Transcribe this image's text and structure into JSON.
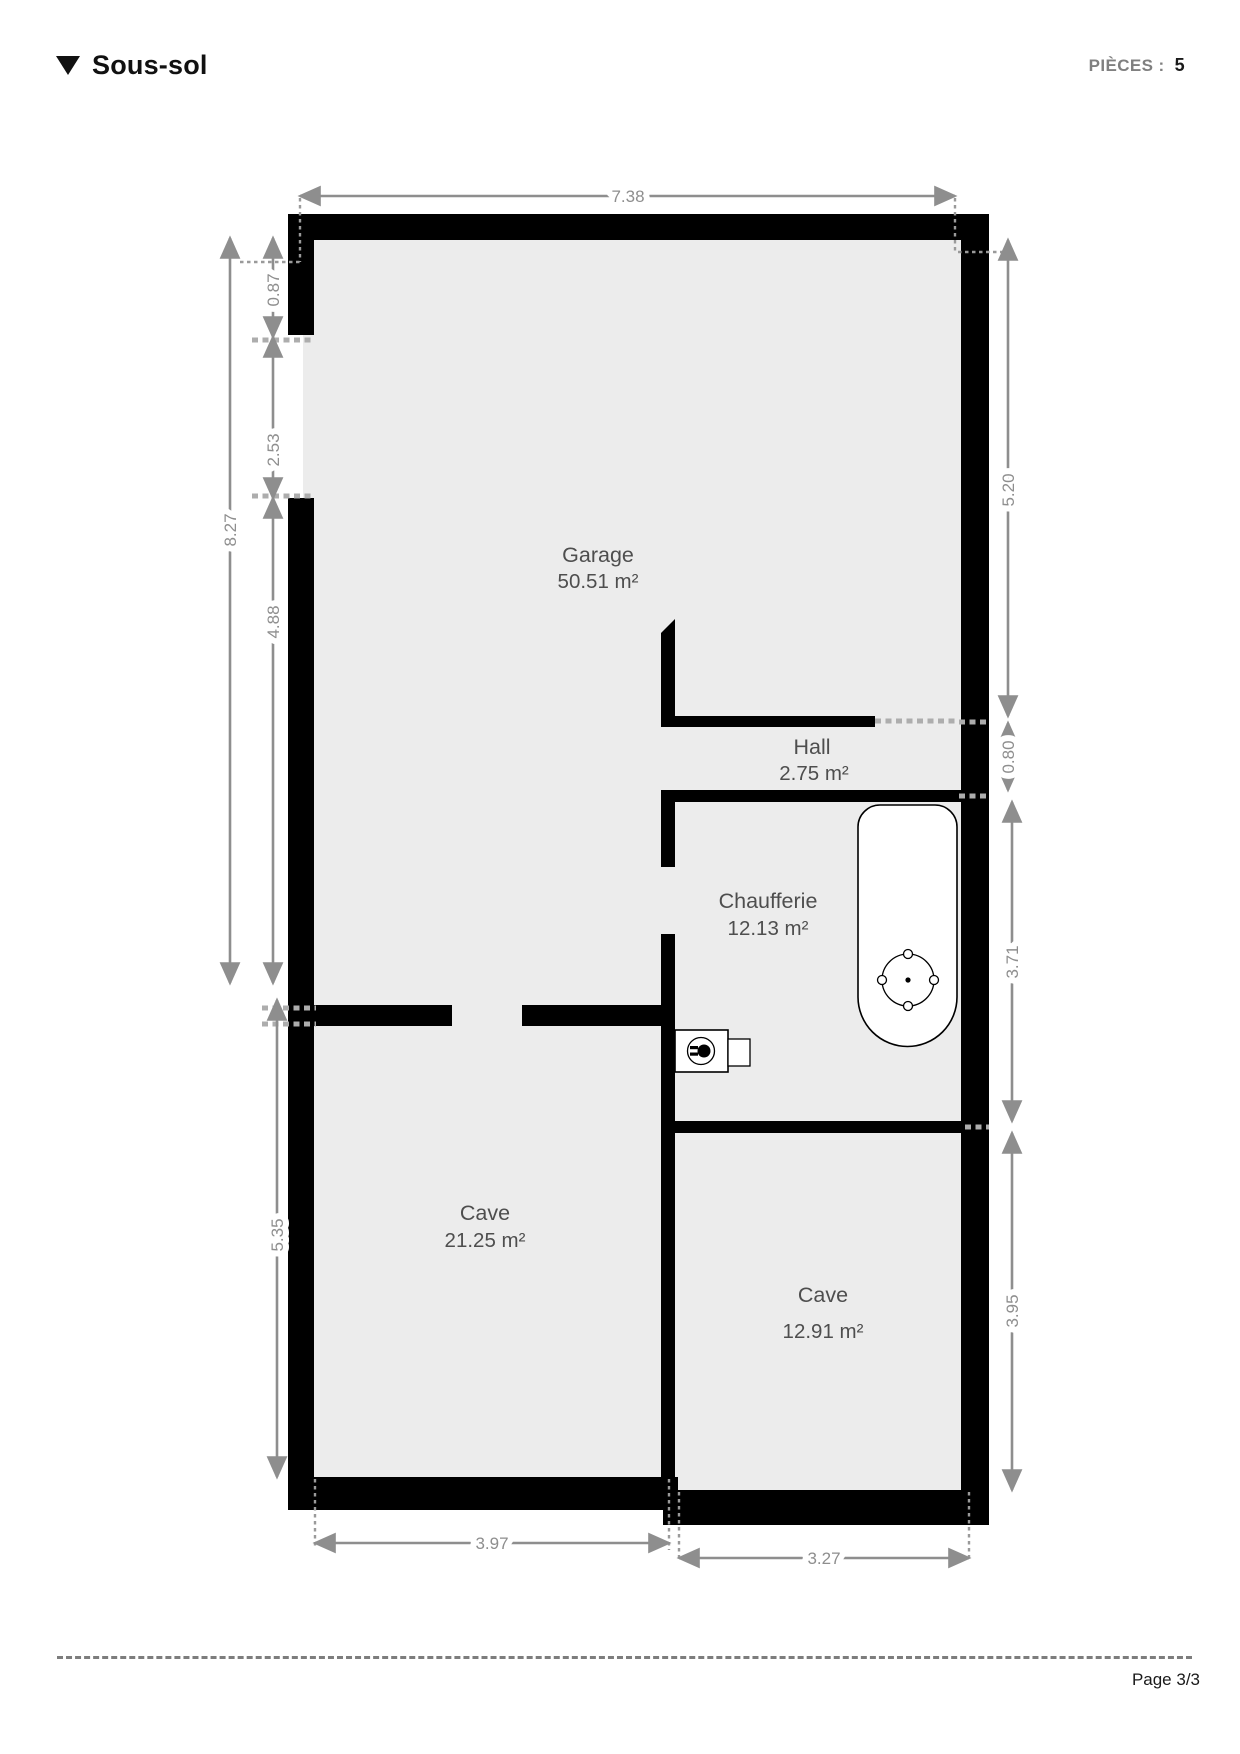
{
  "header": {
    "title": "Sous-sol",
    "pieces_label": "PIÈCES :",
    "pieces_value": "5"
  },
  "plan": {
    "floor_name": "Sous-sol",
    "rooms": [
      {
        "name": "Garage",
        "area": "50.51 m²"
      },
      {
        "name": "Hall",
        "area": "2.75 m²"
      },
      {
        "name": "Chaufferie",
        "area": "12.13 m²"
      },
      {
        "name": "Cave",
        "area": "21.25 m²"
      },
      {
        "name": "Cave",
        "area": "12.91 m²"
      }
    ],
    "dims": {
      "top": "7.38",
      "left_outer": "8.27",
      "left_a": "0.87",
      "left_b": "2.53",
      "left_c": "4.88",
      "left_d": "5.35",
      "right_a": "5.20",
      "right_b": "0.80",
      "right_c": "3.71",
      "right_d": "3.95",
      "bottom_a": "3.97",
      "bottom_b": "3.27"
    },
    "colors": {
      "wall": "#000000",
      "floor": "#ececec",
      "dimension": "#8e8e8e",
      "room_label": "#4e4e4e"
    },
    "symbols": [
      "water-heater",
      "electrical-outlet"
    ]
  },
  "footer": {
    "page": "Page 3/3"
  }
}
